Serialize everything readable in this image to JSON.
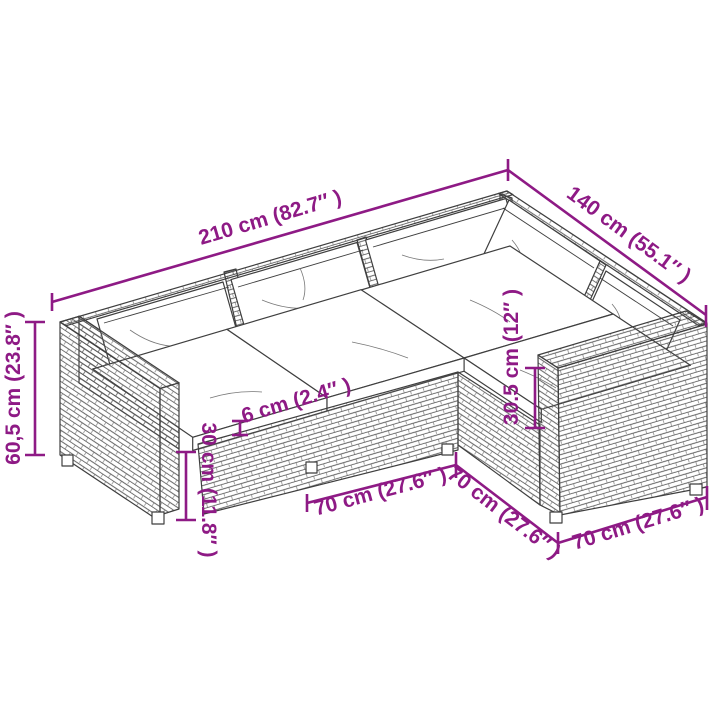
{
  "diagram": {
    "type": "furniture-dimension-diagram",
    "subject": "L-shaped poly rattan garden lounge sofa set with cushions",
    "background": "#ffffff",
    "accent_color": "#8E1A85",
    "line_color": "#3f3f3f"
  },
  "dims": {
    "d210": {
      "label": "210 cm (82.7″ )",
      "value_cm": 210,
      "value_in": 82.7
    },
    "d140": {
      "label": "140 cm (55.1″ )",
      "value_cm": 140,
      "value_in": 55.1
    },
    "d60_5": {
      "label": "60,5 cm (23.8″ )",
      "value_cm": 60.5,
      "value_in": 23.8
    },
    "d30": {
      "label": "30 cm (11.8″ )",
      "value_cm": 30,
      "value_in": 11.8
    },
    "d6": {
      "label": "6 cm (2.4″ )",
      "value_cm": 6,
      "value_in": 2.4
    },
    "d30_5": {
      "label": "30.5 cm (12″ )",
      "value_cm": 30.5,
      "value_in": 12
    },
    "d70a": {
      "label": "70 cm (27.6″ )",
      "value_cm": 70,
      "value_in": 27.6
    },
    "d70b": {
      "label": "70 cm (27.6″ )",
      "value_cm": 70,
      "value_in": 27.6
    },
    "d70c": {
      "label": "70 cm (27.6″ )",
      "value_cm": 70,
      "value_in": 27.6
    }
  }
}
